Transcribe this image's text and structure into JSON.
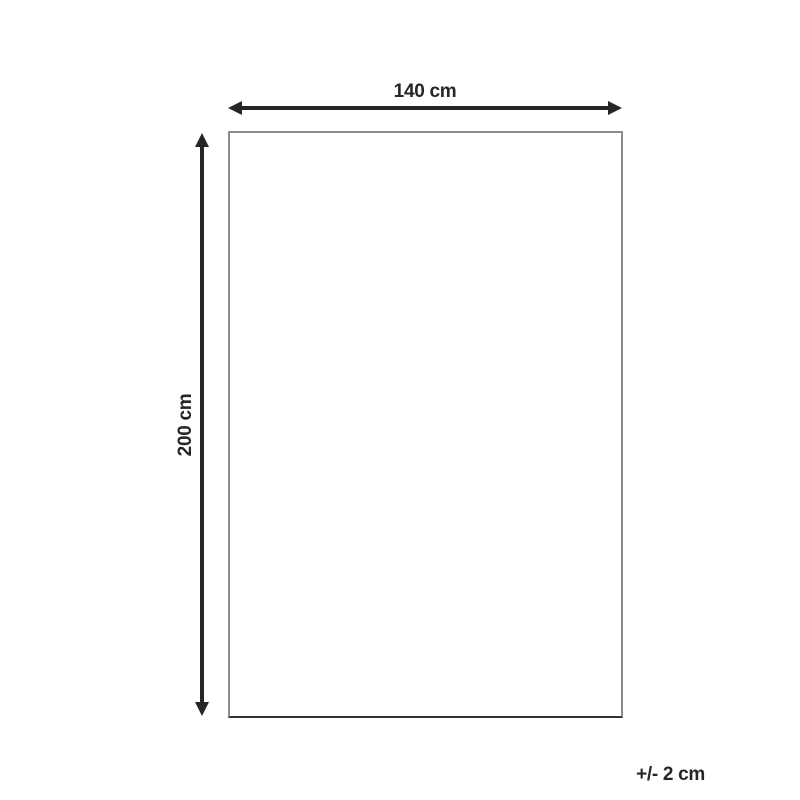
{
  "diagram": {
    "width_label": "140 cm",
    "height_label": "200 cm",
    "tolerance_label": "+/- 2 cm"
  },
  "dimensions": {
    "width_cm": 140,
    "height_cm": 200,
    "tolerance_cm": 2
  },
  "colors": {
    "arrow": "#262626",
    "text": "#262626",
    "rect_border": "#8c8c8c",
    "rect_border_bottom": "#333333",
    "background": "#ffffff"
  }
}
